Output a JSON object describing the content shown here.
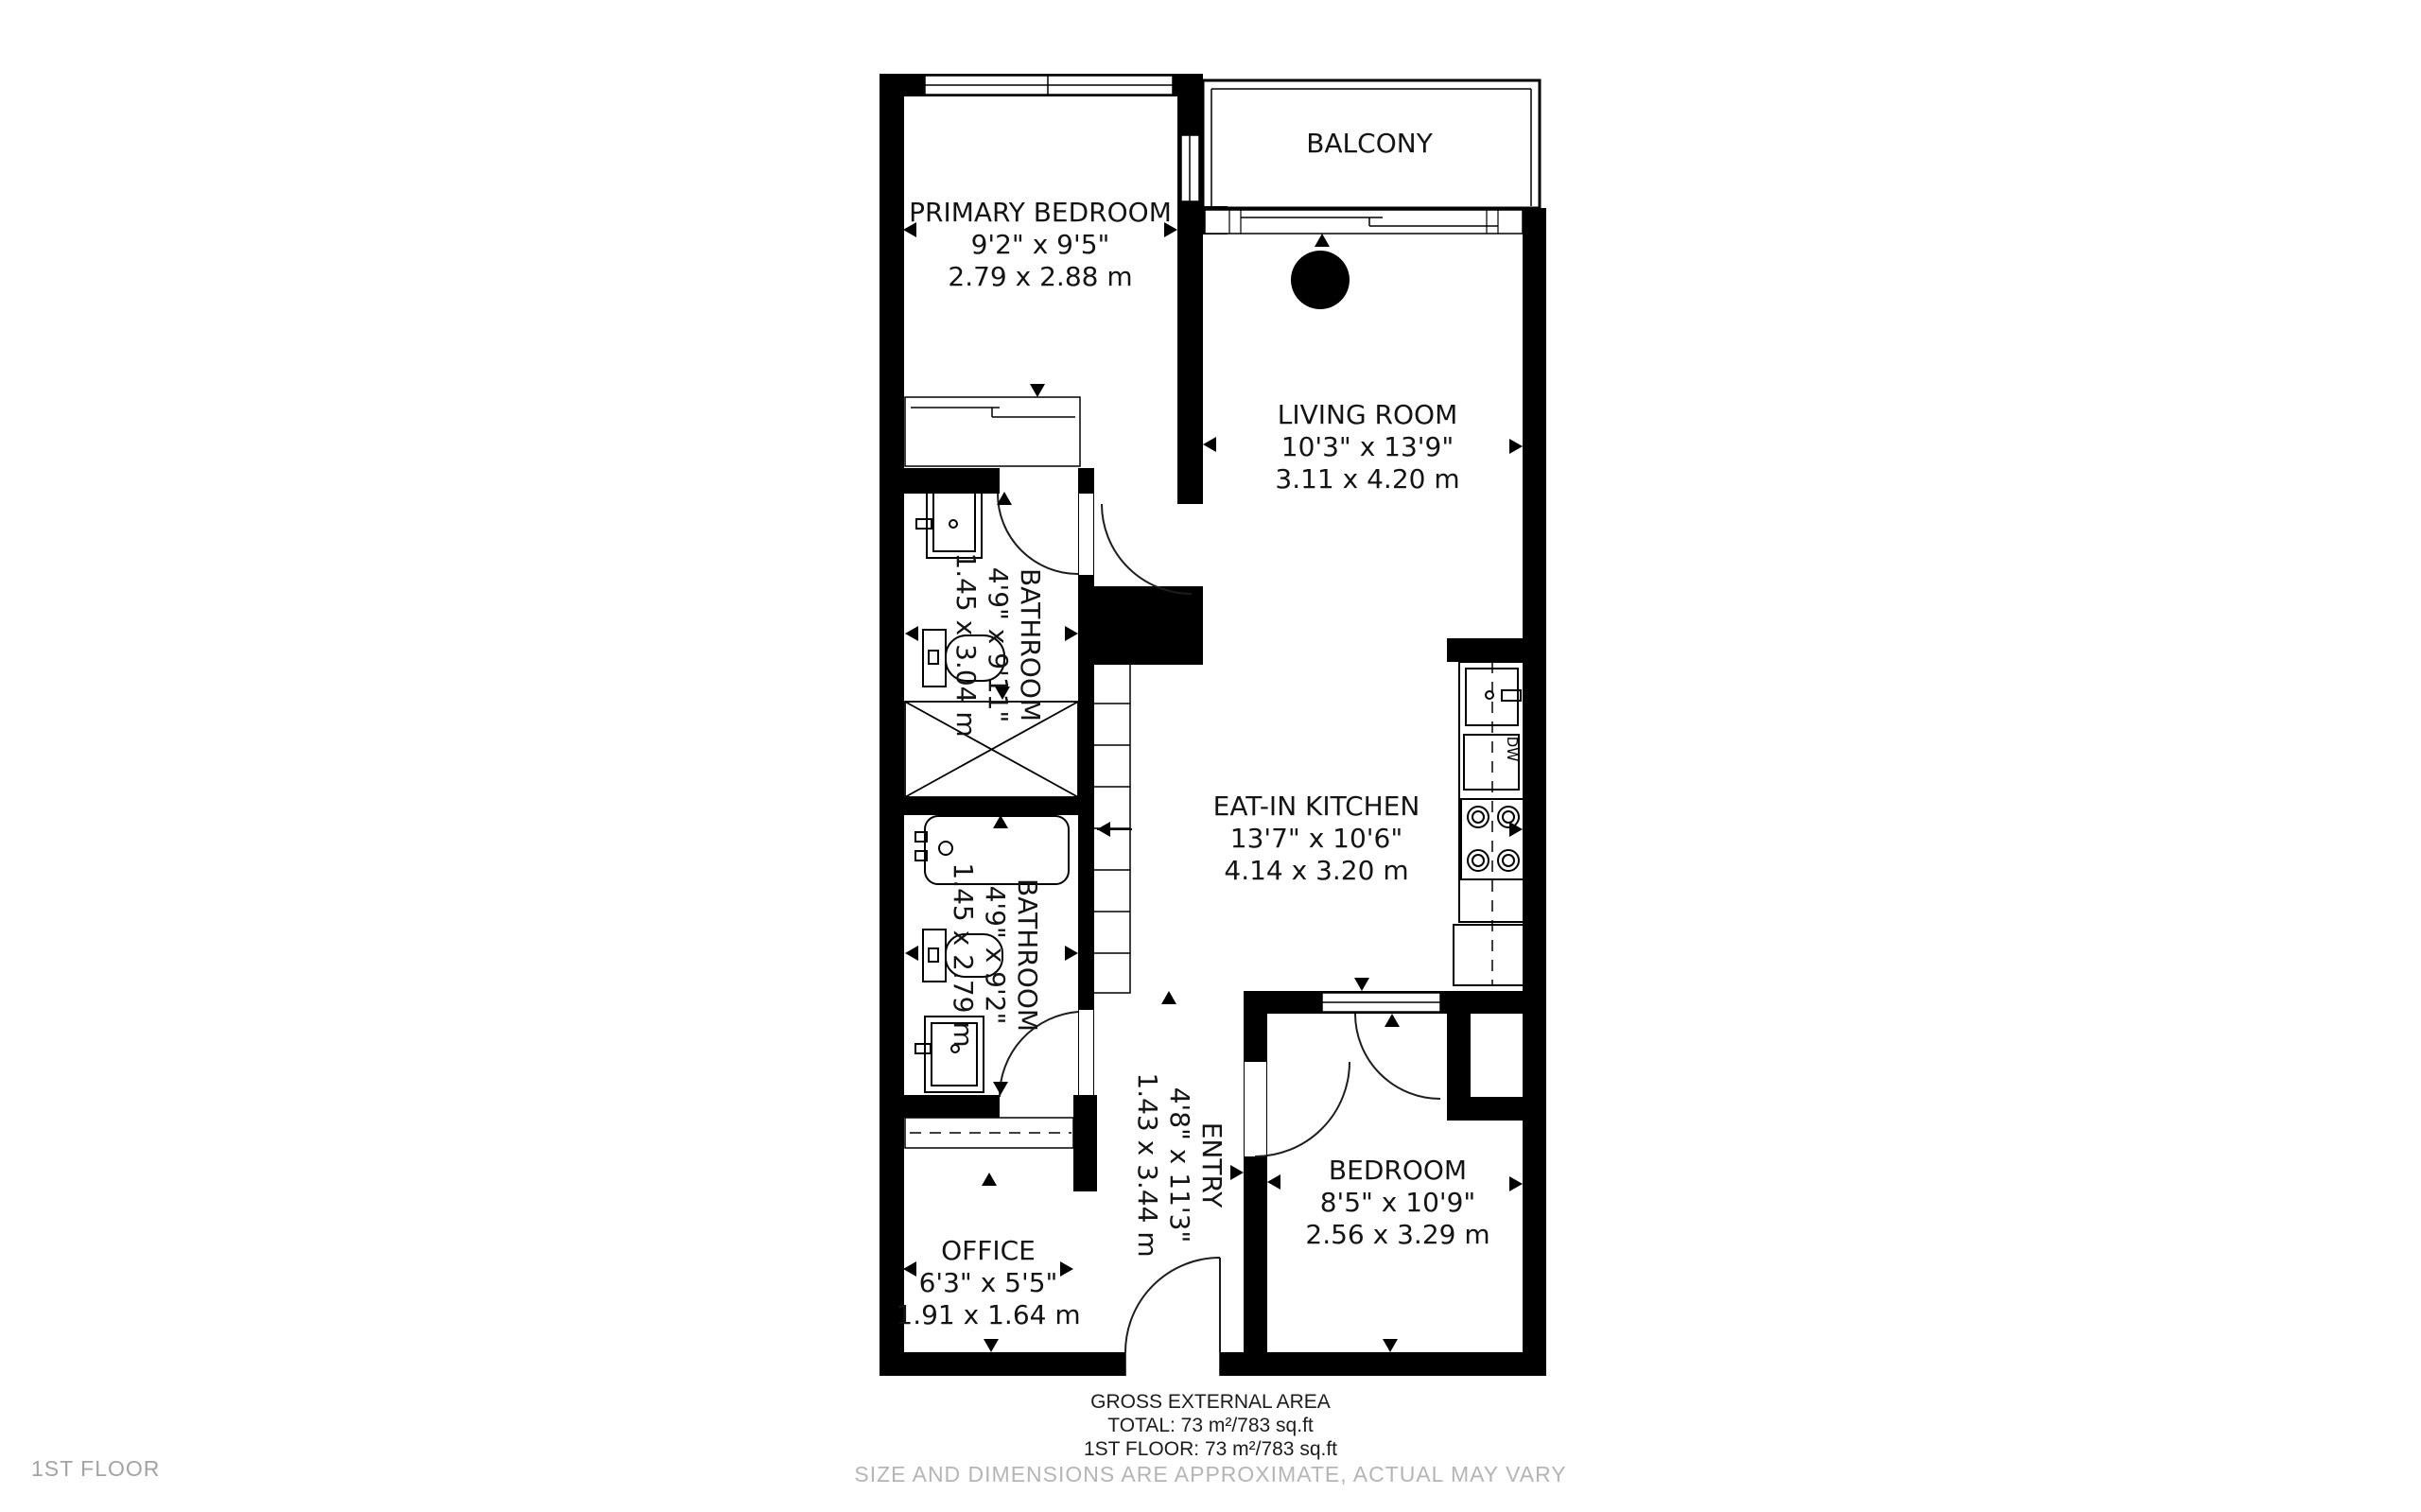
{
  "floor_label": "1ST FLOOR",
  "footer": {
    "line1": "GROSS EXTERNAL AREA",
    "line2": "TOTAL: 73 m²/783 sq.ft",
    "line3": "1ST FLOOR: 73 m²/783 sq.ft",
    "disclaimer": "SIZE AND DIMENSIONS ARE APPROXIMATE, ACTUAL MAY VARY"
  },
  "rooms": [
    {
      "id": "primary-bedroom",
      "name": "PRIMARY BEDROOM",
      "imperial": "9'2\" x 9'5\"",
      "metric": "2.79 x 2.88 m"
    },
    {
      "id": "balcony",
      "name": "BALCONY",
      "imperial": "",
      "metric": ""
    },
    {
      "id": "living-room",
      "name": "LIVING ROOM",
      "imperial": "10'3\" x 13'9\"",
      "metric": "3.11 x 4.20 m"
    },
    {
      "id": "bathroom-1",
      "name": "BATHROOM",
      "imperial": "4'9\" x 9'11\"",
      "metric": "1.45 x 3.04 m"
    },
    {
      "id": "eat-in-kitchen",
      "name": "EAT-IN KITCHEN",
      "imperial": "13'7\" x 10'6\"",
      "metric": "4.14 x 3.20 m"
    },
    {
      "id": "bathroom-2",
      "name": "BATHROOM",
      "imperial": "4'9\" x 9'2\"",
      "metric": "1.45 x 2.79 m"
    },
    {
      "id": "entry",
      "name": "ENTRY",
      "imperial": "4'8\" x 11'3\"",
      "metric": "1.43 x 3.44 m"
    },
    {
      "id": "office",
      "name": "OFFICE",
      "imperial": "6'3\" x 5'5\"",
      "metric": "1.91 x 1.64 m"
    },
    {
      "id": "bedroom",
      "name": "BEDROOM",
      "imperial": "8'5\" x 10'9\"",
      "metric": "2.56 x 3.29 m"
    }
  ],
  "appliances": {
    "dishwasher": "DW"
  },
  "colors": {
    "wall": "#000000",
    "line": "#1d1d1d",
    "muted_text": "#b5b5b5"
  }
}
